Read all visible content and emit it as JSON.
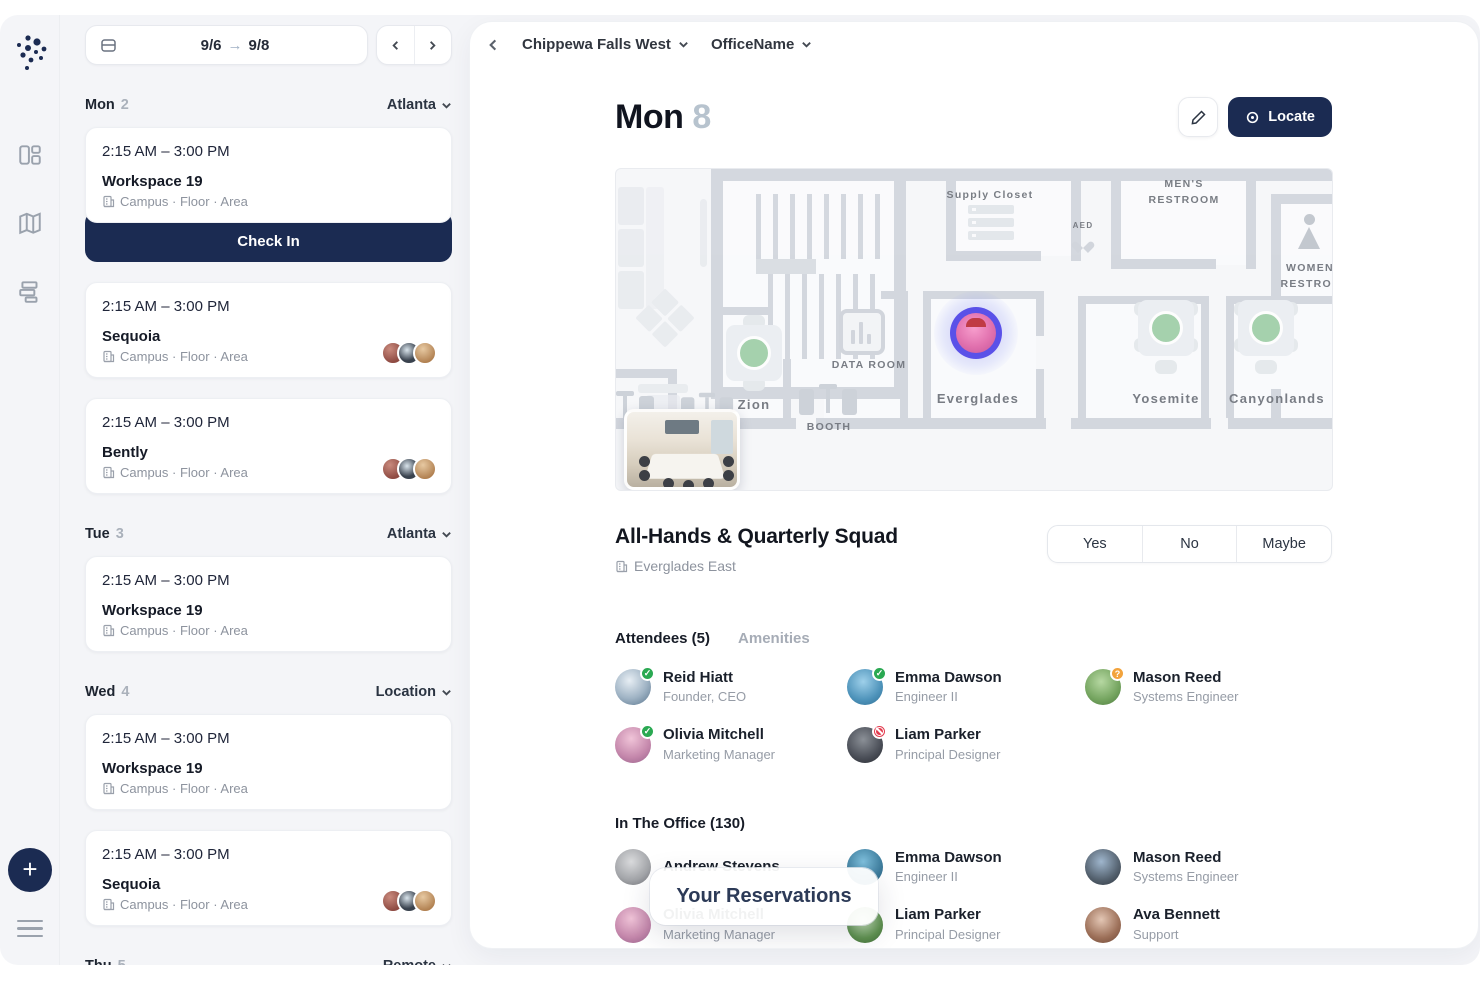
{
  "theme": {
    "navy": "#1b2b52",
    "status_yes": "#2aa952",
    "status_maybe": "#f2a33c",
    "status_no": "#e23b4e",
    "pin_ring": "#5a51e8",
    "available_green": "#94c99d",
    "sidebar_bg": "#f4f5f8"
  },
  "rail": {
    "icons": [
      "dashboard",
      "map",
      "spaces"
    ],
    "plus_label": "+"
  },
  "sidebar": {
    "date_from": "9/6",
    "date_to": "9/8",
    "days": [
      {
        "label": "Mon",
        "num": "2",
        "location": "Atlanta",
        "cards": [
          {
            "time": "2:15 AM – 3:00 PM",
            "title": "Workspace 19",
            "meta": "Campus · Floor · Area",
            "checkin": "Check In"
          },
          {
            "time": "2:15 AM – 3:00 PM",
            "title": "Sequoia",
            "meta": "Campus · Floor · Area"
          },
          {
            "time": "2:15 AM – 3:00 PM",
            "title": "Bently",
            "meta": "Campus · Floor · Area"
          }
        ]
      },
      {
        "label": "Tue",
        "num": "3",
        "location": "Atlanta",
        "cards": [
          {
            "time": "2:15 AM – 3:00 PM",
            "title": "Workspace 19",
            "meta": "Campus · Floor · Area"
          }
        ]
      },
      {
        "label": "Wed",
        "num": "4",
        "location": "Location",
        "cards": [
          {
            "time": "2:15 AM – 3:00 PM",
            "title": "Workspace 19",
            "meta": "Campus · Floor · Area"
          },
          {
            "time": "2:15 AM – 3:00 PM",
            "title": "Sequoia",
            "meta": "Campus · Floor · Area"
          }
        ]
      },
      {
        "label": "Thu",
        "num": "5",
        "location": "Remote",
        "cards": []
      }
    ]
  },
  "main": {
    "breadcrumb": {
      "building": "Chippewa Falls West",
      "office": "OfficeName"
    },
    "title": {
      "day": "Mon",
      "date": "8"
    },
    "locate_label": "Locate",
    "map": {
      "labels": {
        "supply": "Supply Closet",
        "aed": "AED",
        "mens": "MEN'S RESTROOM",
        "womens": "WOMEN'S RESTROOM",
        "data_room": "DATA ROOM",
        "booth": "BOOTH",
        "zion": "Zion",
        "everglades": "Everglades",
        "yosemite": "Yosemite",
        "canyonlands": "Canyonlands"
      }
    },
    "event": {
      "title": "All-Hands & Quarterly Squad",
      "location": "Everglades East",
      "rsvp": [
        "Yes",
        "No",
        "Maybe"
      ]
    },
    "tabs": [
      {
        "label": "Attendees (5)"
      },
      {
        "label": "Amenities"
      }
    ],
    "attendees": [
      {
        "name": "Reid Hiatt",
        "title": "Founder, CEO",
        "status": "yes"
      },
      {
        "name": "Emma Dawson",
        "title": "Engineer II",
        "status": "yes"
      },
      {
        "name": "Mason Reed",
        "title": "Systems Engineer",
        "status": "maybe"
      },
      {
        "name": "Olivia Mitchell",
        "title": "Marketing Manager",
        "status": "yes"
      },
      {
        "name": "Liam Parker",
        "title": "Principal Designer",
        "status": "no"
      }
    ],
    "office": {
      "heading": "In The Office (130)",
      "people": [
        {
          "name": "Andrew Stevens",
          "title": ""
        },
        {
          "name": "Emma Dawson",
          "title": "Engineer II"
        },
        {
          "name": "Mason Reed",
          "title": "Systems Engineer"
        },
        {
          "name": "Olivia Mitchell",
          "title": "Marketing Manager"
        },
        {
          "name": "Liam Parker",
          "title": "Principal Designer"
        },
        {
          "name": "Ava Bennett",
          "title": "Support"
        }
      ]
    },
    "tooltip": "Your Reservations"
  }
}
